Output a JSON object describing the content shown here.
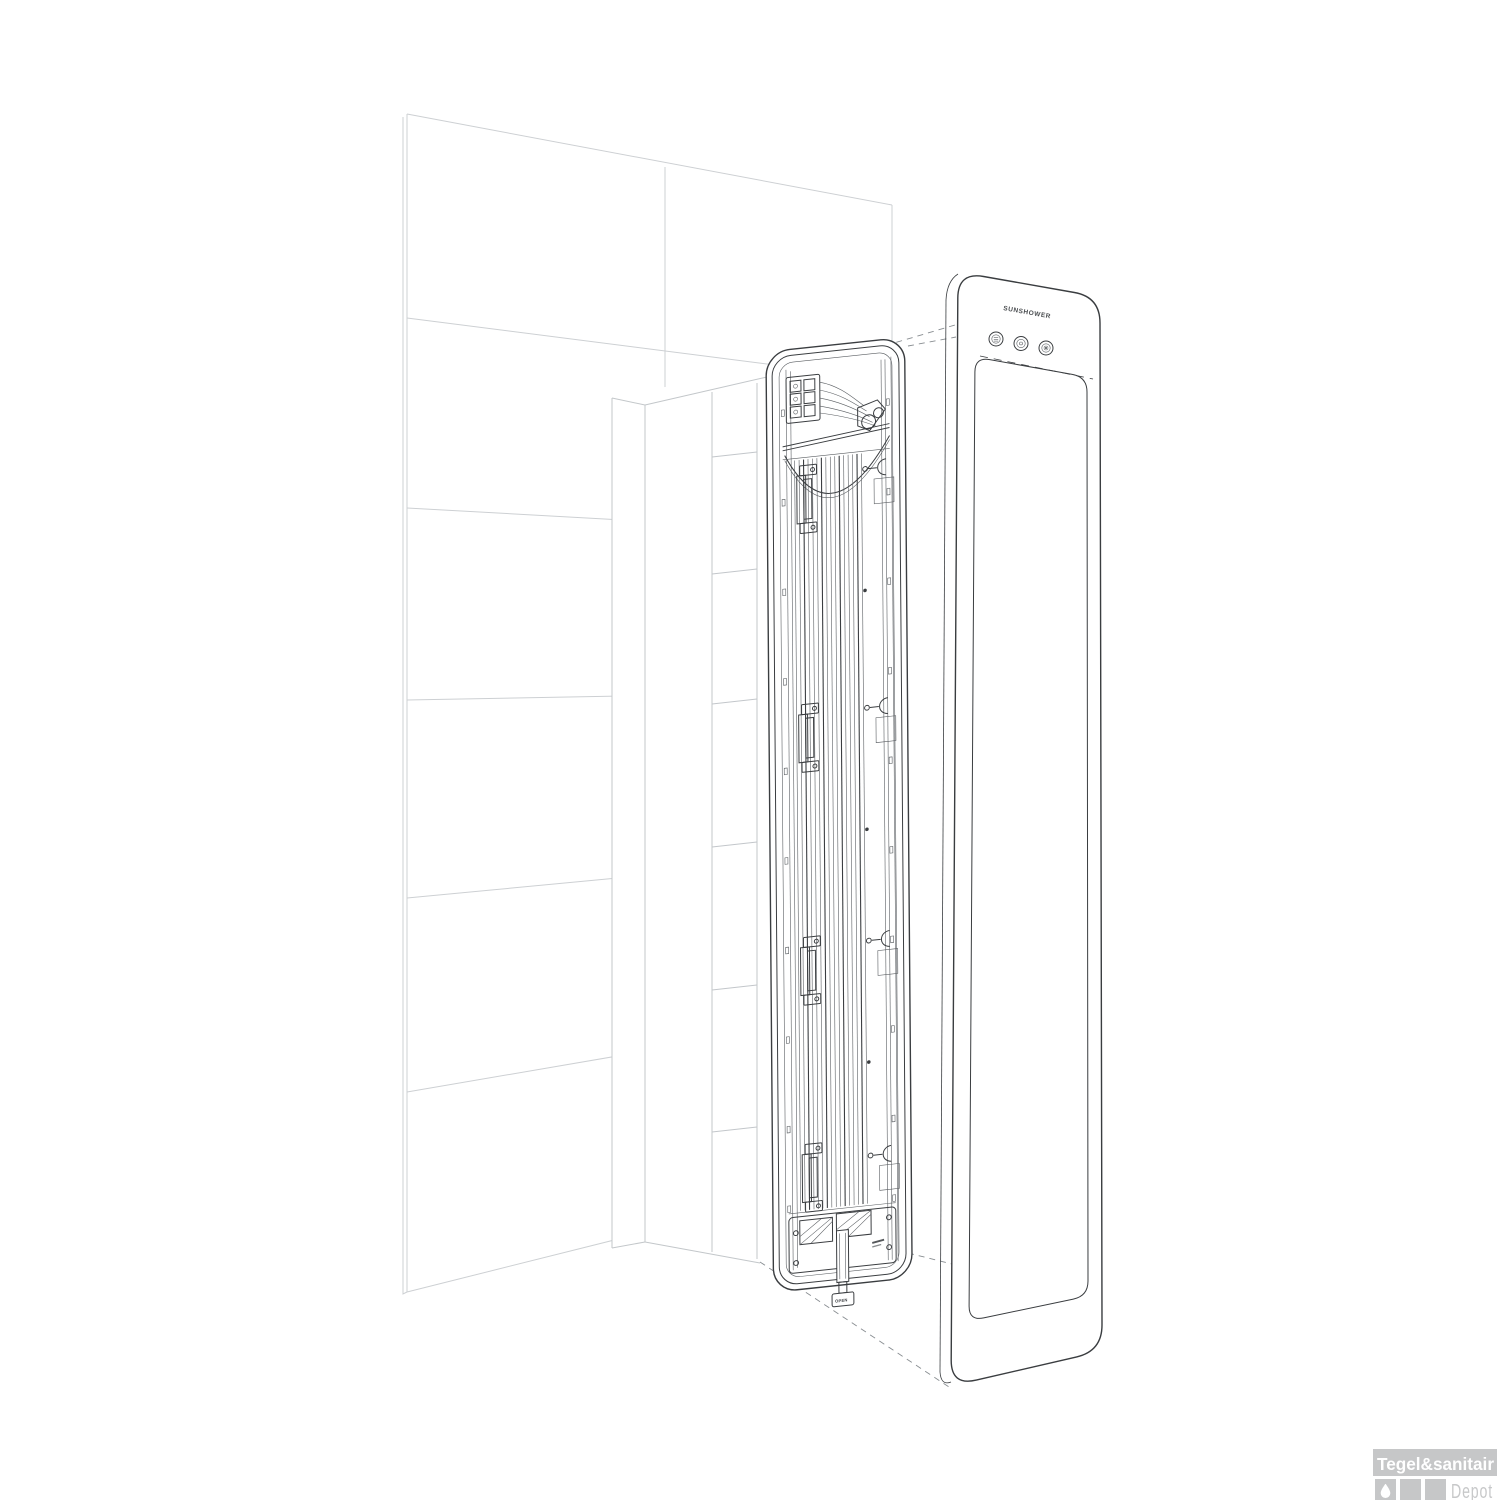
{
  "illustration": {
    "description": "Exploded installation view of a recessed wall-mounted infrared heater: tiled wall with niche, inner mounting frame with lamps, and detached front glass panel",
    "device": {
      "brand_label": "SUNSHOWER",
      "open_tab_label": "OPEN",
      "control_button_icons": [
        "display-icon",
        "power-icon",
        "sun-icon"
      ]
    }
  },
  "logo": {
    "title": "Tegel&sanitair",
    "subtitle": "Depot",
    "drop_icon": "water-drop"
  },
  "colors": {
    "background": "#ffffff",
    "line_dark": "#3a3d40",
    "line_light": "#cdd0d3",
    "dashed_projection": "#888d91",
    "logo_gray": "#c6c7c8",
    "logo_text_white": "#ffffff"
  }
}
